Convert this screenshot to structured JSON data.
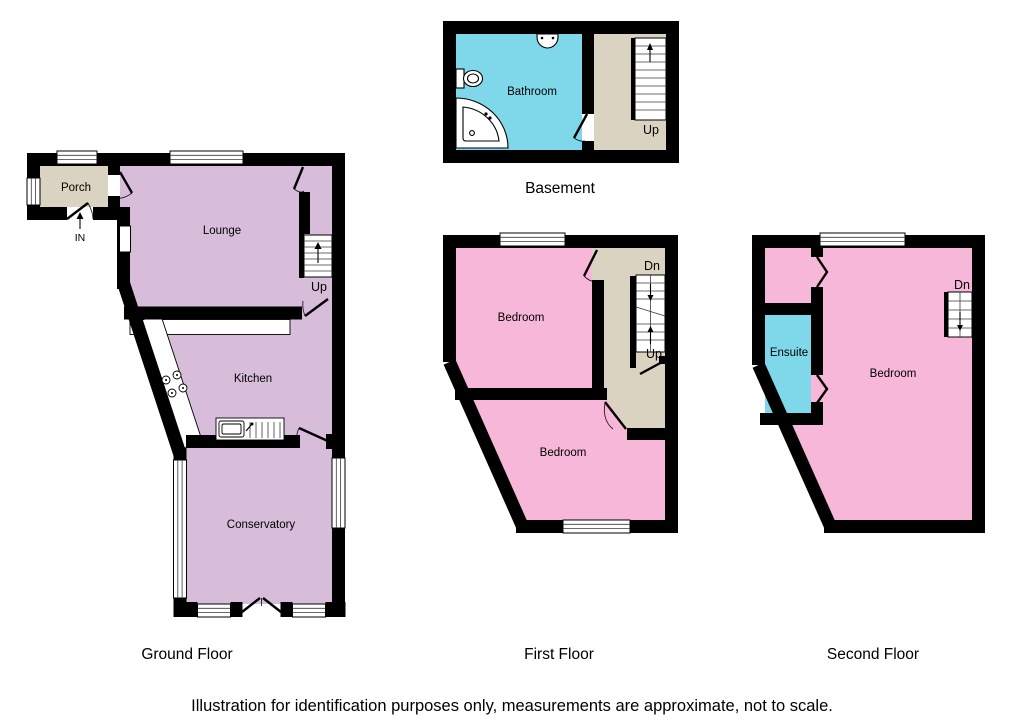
{
  "colors": {
    "wall": "#000000",
    "ground_room": "#D8BDDA",
    "bedroom_pink": "#F7B7D9",
    "wet_room_cyan": "#7FD8EA",
    "hall_beige": "#DBD3C1",
    "white": "#FFFFFF"
  },
  "basement": {
    "title": "Basement",
    "bathroom": "Bathroom",
    "up": "Up"
  },
  "ground": {
    "title": "Ground Floor",
    "porch": "Porch",
    "lounge": "Lounge",
    "kitchen": "Kitchen",
    "conservatory": "Conservatory",
    "up": "Up",
    "entrance": "IN"
  },
  "first": {
    "title": "First Floor",
    "bedroom_front": "Bedroom",
    "bedroom_back": "Bedroom",
    "dn": "Dn",
    "up": "Up"
  },
  "second": {
    "title": "Second Floor",
    "bedroom": "Bedroom",
    "ensuite": "Ensuite",
    "dn": "Dn"
  },
  "caption": "Illustration for identification purposes only, measurements are approximate, not to scale."
}
